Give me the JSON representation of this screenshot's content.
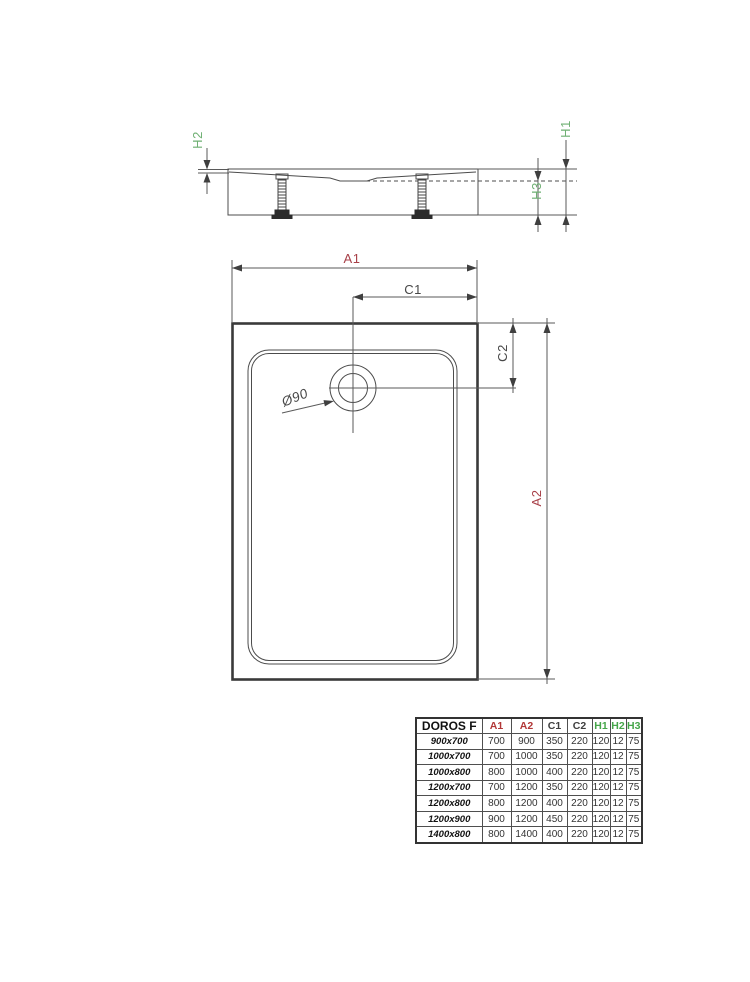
{
  "drawing": {
    "side_view": {
      "labels": {
        "h1": "H1",
        "h2": "H2",
        "h3": "H3"
      }
    },
    "plan_view": {
      "labels": {
        "a1": "A1",
        "a2": "A2",
        "c1": "C1",
        "c2": "C2",
        "drain_diameter": "Ø90"
      }
    }
  },
  "colors": {
    "dimension_red": "#a84048",
    "dimension_green": "#6fb073",
    "dimension_dark": "#474747",
    "drawing_line": "#4c4c4c",
    "table_header_red": "#b23737",
    "table_header_green": "#46a64a"
  },
  "table": {
    "headers": [
      "DOROS F",
      "A1",
      "A2",
      "C1",
      "C2",
      "H1",
      "H2",
      "H3"
    ],
    "rows": [
      [
        "900x700",
        "700",
        "900",
        "350",
        "220",
        "120",
        "12",
        "75"
      ],
      [
        "1000x700",
        "700",
        "1000",
        "350",
        "220",
        "120",
        "12",
        "75"
      ],
      [
        "1000x800",
        "800",
        "1000",
        "400",
        "220",
        "120",
        "12",
        "75"
      ],
      [
        "1200x700",
        "700",
        "1200",
        "350",
        "220",
        "120",
        "12",
        "75"
      ],
      [
        "1200x800",
        "800",
        "1200",
        "400",
        "220",
        "120",
        "12",
        "75"
      ],
      [
        "1200x900",
        "900",
        "1200",
        "450",
        "220",
        "120",
        "12",
        "75"
      ],
      [
        "1400x800",
        "800",
        "1400",
        "400",
        "220",
        "120",
        "12",
        "75"
      ]
    ]
  }
}
